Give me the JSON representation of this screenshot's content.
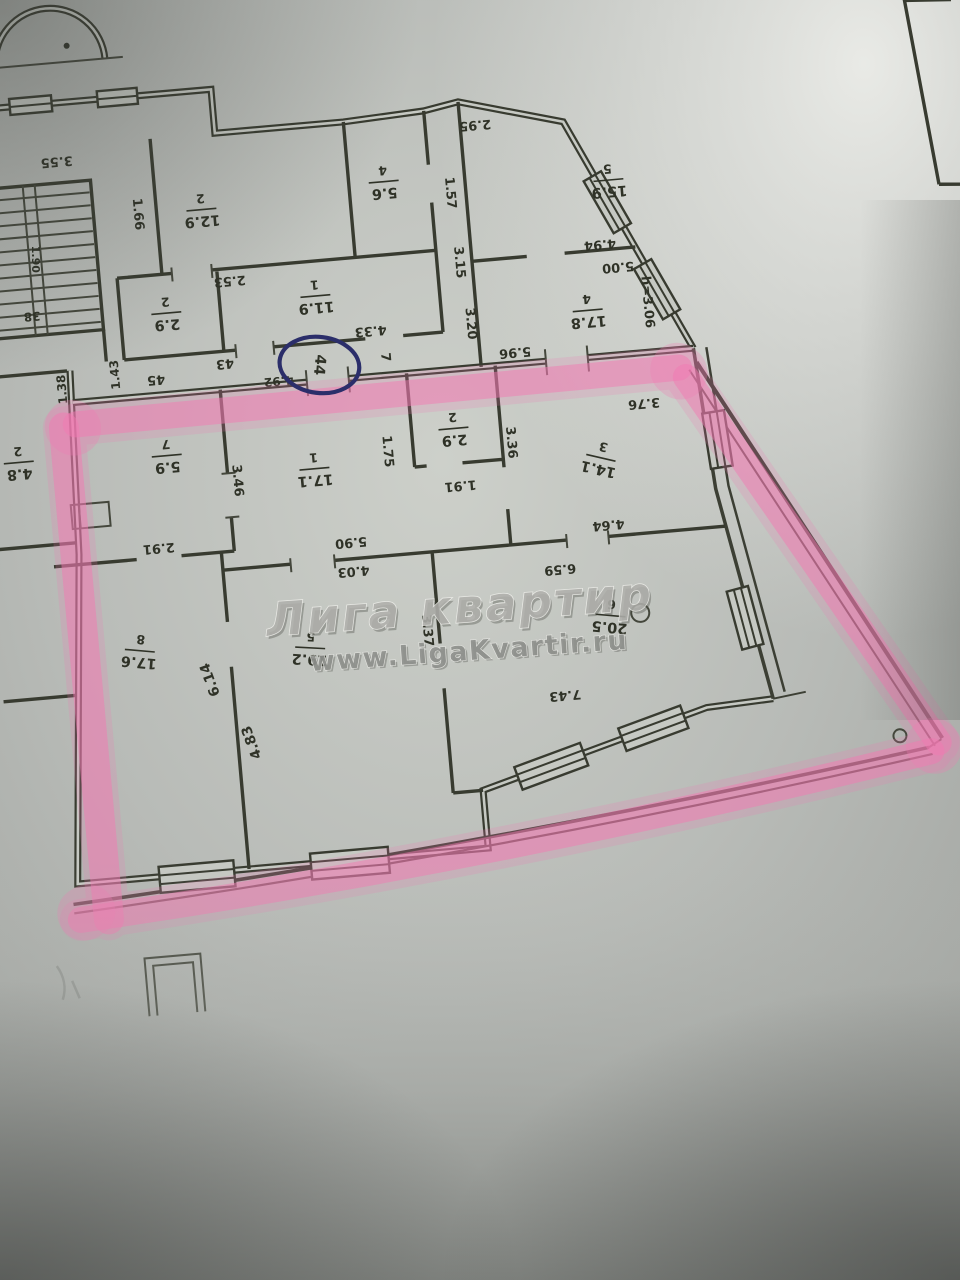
{
  "watermark": {
    "line1": "Лига квартир",
    "line2": "www.LigaKvartir.ru"
  },
  "colors": {
    "highlighter": "#f07ab2",
    "pen_circle": "#2b2e6a",
    "ink": "#32352b",
    "paper": "#b4b7b3"
  },
  "circled_unit_number": "44",
  "landing_unit_numbers": [
    "45",
    "43",
    "44",
    "7"
  ],
  "room_labels": [
    {
      "id": "room-12-9",
      "number": "2",
      "area": "12.9",
      "x": 240,
      "y": 188,
      "r": 180
    },
    {
      "id": "room-5-6",
      "number": "4",
      "area": "5.6",
      "x": 424,
      "y": 176,
      "r": 180
    },
    {
      "id": "room-11-9",
      "number": "1",
      "area": "11.9",
      "x": 346,
      "y": 284,
      "r": 180
    },
    {
      "id": "room-2-9-upper",
      "number": "2",
      "area": "2.9",
      "x": 196,
      "y": 288,
      "r": 180
    },
    {
      "id": "room-15-9",
      "number": "5",
      "area": "15.9",
      "x": 648,
      "y": 194,
      "r": 180
    },
    {
      "id": "room-17-8",
      "number": "4",
      "area": "17.8",
      "x": 616,
      "y": 322,
      "r": 180
    },
    {
      "id": "room-4-8",
      "number": "2",
      "area": "4.8",
      "x": 36,
      "y": 424,
      "r": 180
    },
    {
      "id": "room-5-9",
      "number": "7",
      "area": "5.9",
      "x": 184,
      "y": 430,
      "r": 180
    },
    {
      "id": "room-17-1",
      "number": "1",
      "area": "17.1",
      "x": 330,
      "y": 456,
      "r": 180
    },
    {
      "id": "room-2-9",
      "number": "2",
      "area": "2.9",
      "x": 472,
      "y": 428,
      "r": 180
    },
    {
      "id": "room-14-1",
      "number": "3",
      "area": "14.1",
      "x": 616,
      "y": 470,
      "r": 198
    },
    {
      "id": "room-19-2",
      "number": "5",
      "area": "19.2",
      "x": 310,
      "y": 634,
      "r": 188
    },
    {
      "id": "room-17-6",
      "number": "8",
      "area": "17.6",
      "x": 140,
      "y": 622,
      "r": 190
    },
    {
      "id": "room-20-5",
      "number": "6",
      "area": "20.5",
      "x": 612,
      "y": 628,
      "r": 190
    }
  ],
  "dim_labels": [
    {
      "id": "dim-3-55",
      "text": "3.55",
      "x": 100,
      "y": 126,
      "r": 180,
      "s": 13
    },
    {
      "id": "dim-1-66",
      "text": "1.66",
      "x": 176,
      "y": 186,
      "r": 90,
      "s": 13
    },
    {
      "id": "dim-1-90",
      "text": "1.90",
      "x": 70,
      "y": 222,
      "r": 95,
      "s": 11
    },
    {
      "id": "dim-38",
      "text": "38",
      "x": 62,
      "y": 278,
      "r": 180,
      "s": 12
    },
    {
      "id": "dim-2-53",
      "text": "2.53",
      "x": 262,
      "y": 260,
      "r": 180,
      "s": 13
    },
    {
      "id": "dim-4-33",
      "text": "4.33",
      "x": 398,
      "y": 322,
      "r": 180,
      "s": 13
    },
    {
      "id": "dim-1-57",
      "text": "1.57",
      "x": 489,
      "y": 192,
      "r": 90,
      "s": 13
    },
    {
      "id": "dim-3-15",
      "text": "3.15",
      "x": 492,
      "y": 262,
      "r": 90,
      "s": 13
    },
    {
      "id": "dim-3-20",
      "text": "3.20",
      "x": 498,
      "y": 324,
      "r": 90,
      "s": 13
    },
    {
      "id": "dim-2-95",
      "text": "2.95",
      "x": 520,
      "y": 126,
      "r": 180,
      "s": 13
    },
    {
      "id": "dim-4-94",
      "text": "4.94",
      "x": 634,
      "y": 256,
      "r": 180,
      "s": 13
    },
    {
      "id": "dim-5-00",
      "text": "5.00",
      "x": 650,
      "y": 280,
      "r": 180,
      "s": 13
    },
    {
      "id": "dim-h-3-06",
      "text": "h=3.06",
      "x": 676,
      "y": 318,
      "r": 90,
      "s": 13
    },
    {
      "id": "dim-1-43",
      "text": "1.43",
      "x": 140,
      "y": 344,
      "r": -90,
      "s": 12
    },
    {
      "id": "dim-1-38",
      "text": "1.38",
      "x": 86,
      "y": 354,
      "r": -90,
      "s": 12
    },
    {
      "id": "unit-45",
      "text": "45",
      "x": 180,
      "y": 352,
      "r": 180,
      "s": 13
    },
    {
      "id": "unit-43",
      "text": "43",
      "x": 250,
      "y": 342,
      "r": 180,
      "s": 13
    },
    {
      "id": "dim-4-92",
      "text": "4.92",
      "x": 302,
      "y": 364,
      "r": 180,
      "s": 12
    },
    {
      "id": "unit-7",
      "text": "7",
      "x": 410,
      "y": 350,
      "r": 90,
      "s": 13
    },
    {
      "id": "dim-5-96",
      "text": "5.96",
      "x": 540,
      "y": 356,
      "r": 180,
      "s": 13
    },
    {
      "id": "dim-3-46",
      "text": "3.46",
      "x": 252,
      "y": 460,
      "r": 90,
      "s": 13
    },
    {
      "id": "dim-2-91",
      "text": "2.91",
      "x": 168,
      "y": 520,
      "r": 180,
      "s": 13
    },
    {
      "id": "dim-1-75",
      "text": "1.75",
      "x": 404,
      "y": 444,
      "r": 90,
      "s": 13
    },
    {
      "id": "dim-1-91",
      "text": "1.91",
      "x": 474,
      "y": 484,
      "r": 180,
      "s": 13
    },
    {
      "id": "dim-3-36",
      "text": "3.36",
      "x": 528,
      "y": 446,
      "r": 90,
      "s": 13
    },
    {
      "id": "dim-3-76",
      "text": "3.76",
      "x": 664,
      "y": 418,
      "r": 180,
      "s": 13
    },
    {
      "id": "dim-4-64",
      "text": "4.64",
      "x": 618,
      "y": 536,
      "r": 180,
      "s": 13
    },
    {
      "id": "dim-6-59",
      "text": "6.59",
      "x": 566,
      "y": 576,
      "r": 180,
      "s": 13
    },
    {
      "id": "dim-5-90",
      "text": "5.90",
      "x": 360,
      "y": 531,
      "r": 180,
      "s": 13
    },
    {
      "id": "dim-4-03",
      "text": "4.03",
      "x": 360,
      "y": 560,
      "r": 180,
      "s": 13
    },
    {
      "id": "dim-6-14",
      "text": "6.14",
      "x": 208,
      "y": 656,
      "r": -105,
      "s": 14
    },
    {
      "id": "dim-4-83",
      "text": "4.83",
      "x": 244,
      "y": 722,
      "r": -105,
      "s": 14
    },
    {
      "id": "dim-3-37",
      "text": "3.37",
      "x": 428,
      "y": 626,
      "r": 90,
      "s": 13
    },
    {
      "id": "dim-7-43",
      "text": "7.43",
      "x": 560,
      "y": 702,
      "r": 180,
      "s": 13
    },
    {
      "id": "unit-44-circled",
      "text": "44",
      "x": 344,
      "y": 352,
      "r": 100,
      "s": 15
    }
  ]
}
